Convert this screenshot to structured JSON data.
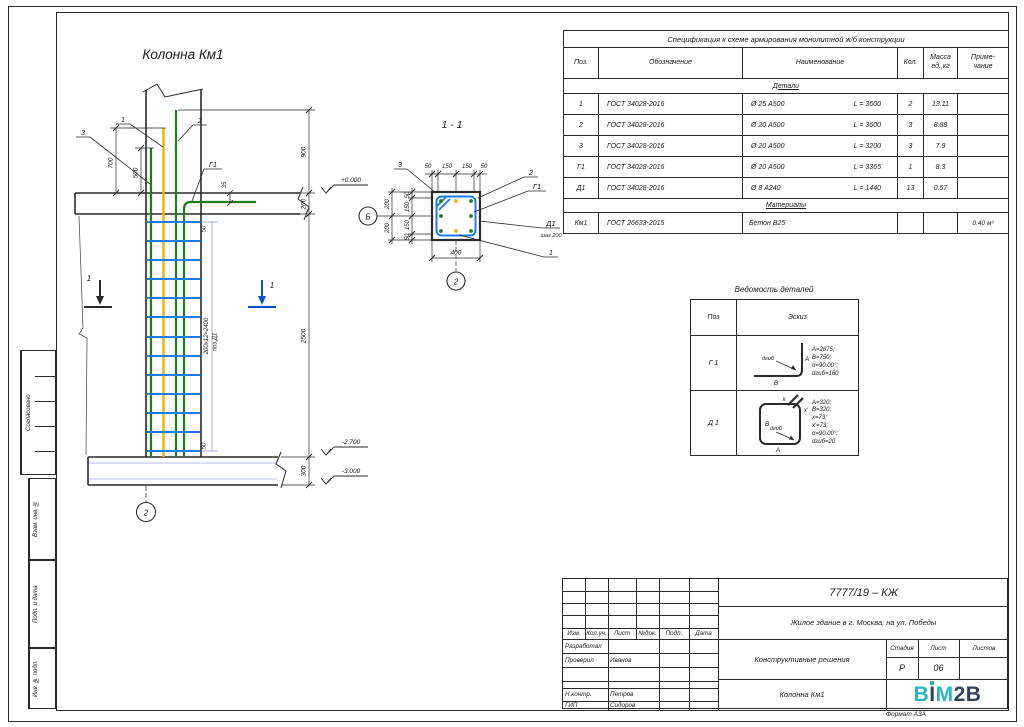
{
  "colors": {
    "line": "#2a2a2a",
    "rebar_green": "#1c7e1c",
    "rebar_yellow": "#f0b400",
    "stirrup_blue": "#1d7bf0",
    "lavender": "#8f95da",
    "cut_blue": "#0a50cc",
    "hatch_light": "#b9c0ea",
    "logo_teal": "#2ab5c4",
    "logo_navy": "#32405a"
  },
  "elevation": {
    "title": "Колонна Км1",
    "dims": {
      "d700": "700",
      "d500": "500",
      "d35": "35",
      "d900": "900",
      "d200": "200",
      "d2500": "2500",
      "d300": "300",
      "d50a": "50",
      "d50b": "50"
    },
    "levels": {
      "top": "+0.000",
      "mid": "-2.700",
      "bot": "-3.000"
    },
    "notes": {
      "spacing": "200х12=2400",
      "pos": "поз.Д1"
    },
    "labels": {
      "p1": "1",
      "p2": "2",
      "p3": "3",
      "g1": "Г1",
      "cut_left": "1",
      "cut_right": "1",
      "axis_2": "2"
    }
  },
  "section": {
    "title": "1 - 1",
    "dims_top": [
      "50",
      "150",
      "150",
      "50"
    ],
    "dims_left_inner": [
      "50",
      "150",
      "150",
      "50"
    ],
    "dims_left_outer": [
      "200",
      "200"
    ],
    "dim_bottom": "400",
    "labels": {
      "p1": "1",
      "p2": "2",
      "p3": "3",
      "g1": "Г1",
      "d1": "Д1",
      "step": "шаг 200",
      "axis_b": "Б",
      "axis_2": "2"
    }
  },
  "spec": {
    "title": "Спецификация к схеме армирования монолитной ж/б конструкции",
    "col_pos": "Поз.",
    "col_doc": "Обозначение",
    "col_name": "Наименование",
    "col_qty": "Кол.",
    "col_mass": "Масса\nед.,кг",
    "col_note": "Приме-\nчание",
    "section1": "Детали",
    "rows": [
      {
        "pos": "1",
        "doc": "ГОСТ 34028-2016",
        "name": "Ø 25 А500",
        "len": "L = 3600",
        "qty": "2",
        "mass": "13.11",
        "note": ""
      },
      {
        "pos": "2",
        "doc": "ГОСТ 34028-2016",
        "name": "Ø 20 А500",
        "len": "L = 3600",
        "qty": "3",
        "mass": "8.88",
        "note": ""
      },
      {
        "pos": "3",
        "doc": "ГОСТ 34028-2016",
        "name": "Ø 20 А500",
        "len": "L = 3200",
        "qty": "3",
        "mass": "7.9",
        "note": ""
      },
      {
        "pos": "Г1",
        "doc": "ГОСТ 34028-2016",
        "name": "Ø 20 А500",
        "len": "L = 3365",
        "qty": "1",
        "mass": "8.3",
        "note": ""
      },
      {
        "pos": "Д1",
        "doc": "ГОСТ 34028-2016",
        "name": "Ø 8 А240",
        "len": "L = 1440",
        "qty": "13",
        "mass": "0.57",
        "note": ""
      }
    ],
    "section2": "Материалы",
    "material_row": {
      "pos": "Км1",
      "doc": "ГОСТ 26633-2015",
      "name": "Бетон В25",
      "len": "",
      "qty": "",
      "mass": "",
      "note": "0.40 м³"
    }
  },
  "vedomost": {
    "title": "Ведомость деталей",
    "col_pos": "Поз",
    "col_sketch": "Эскиз",
    "rows": [
      {
        "pos": "Г 1",
        "params": "A=2675;\nB=750;\nα=90.00°;\ndгиб=160",
        "labels": {
          "a": "A",
          "b": "B",
          "d": "dгиб"
        }
      },
      {
        "pos": "Д 1",
        "params": "A=320;\nB=320;\nx=73;\nx'=73;\nα=90.00°;\ndгиб=20",
        "labels": {
          "a": "A",
          "b": "B",
          "x": "x",
          "x2": "x'",
          "d": "dгиб"
        }
      }
    ]
  },
  "title_block": {
    "header_cols": [
      "Изм.",
      "Кол.уч.",
      "Лист",
      "№док.",
      "Подп.",
      "Дата"
    ],
    "roles": [
      {
        "role": "Разработал",
        "name": ""
      },
      {
        "role": "Проверил",
        "name": "Иванов"
      },
      {
        "role": "Н.контр.",
        "name": "Петров"
      },
      {
        "role": "ГИП",
        "name": "Сидоров"
      }
    ],
    "code": "7777/19 – КЖ",
    "object": "Жилое здание в г. Москва, на ул. Победы",
    "doc_type": "Конструктивные решения",
    "drawing_name": "Колонна Км1",
    "stage_label": "Стадия",
    "sheet_label": "Лист",
    "sheets_label": "Листов",
    "stage": "Р",
    "sheet": "06",
    "sheets": "",
    "logo": {
      "p1": "B",
      "p2": "I",
      "p3": "M",
      "p4": "2B"
    },
    "format_label": "Формат А3А"
  },
  "side_stamps": {
    "sogl": "Согласовано",
    "vzam": "Взам. инв. №",
    "podp": "Подп. и дата",
    "inv": "Инв. № подл."
  }
}
